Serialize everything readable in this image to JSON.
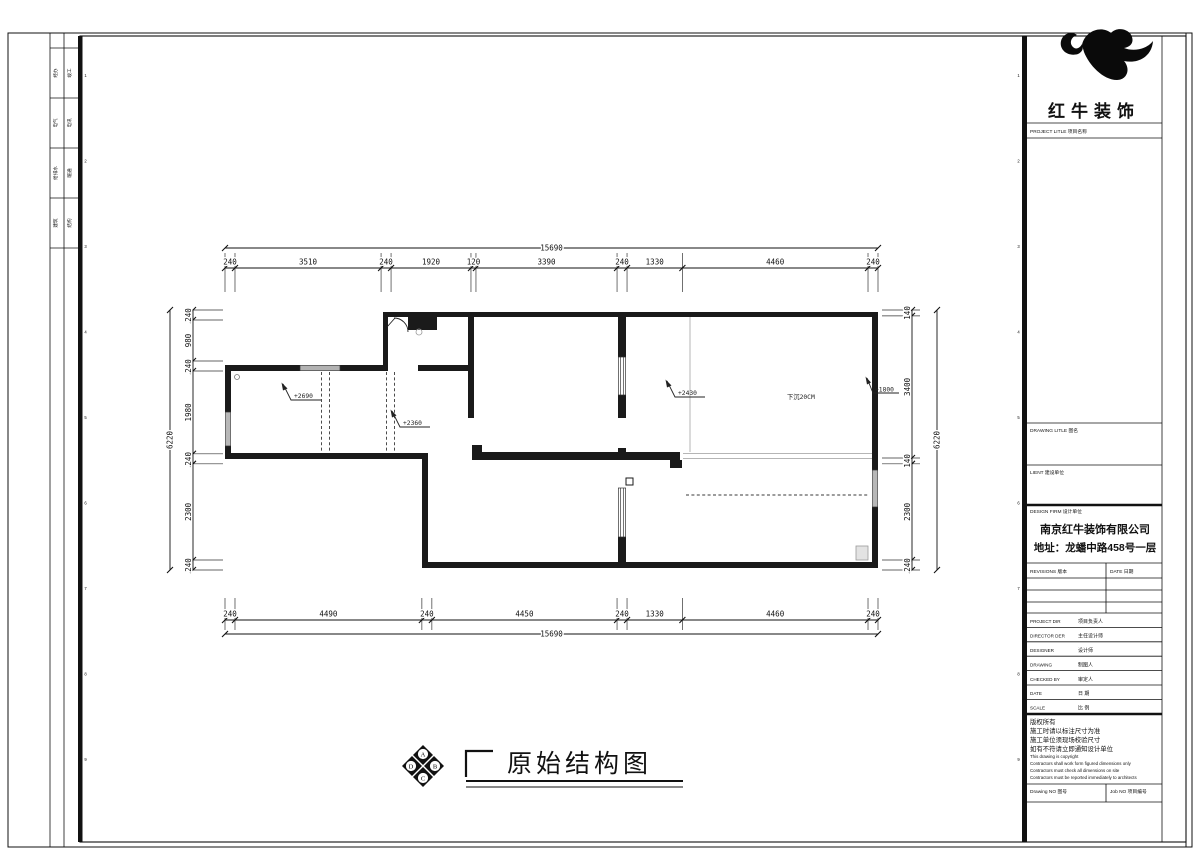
{
  "sheet": {
    "margin_numbers": [
      "1",
      "2",
      "3",
      "4",
      "5",
      "6",
      "7",
      "8",
      "9"
    ],
    "discipline_strip": [
      {
        "col1": "经办",
        "col2": "竣工"
      },
      {
        "col1": "电气",
        "col2": "电讯"
      },
      {
        "col1": "给排水",
        "col2": "暖通"
      },
      {
        "col1": "建筑",
        "col2": "结构"
      }
    ]
  },
  "title_block": {
    "brand": "红牛装饰",
    "project_title_label": "PROJECT LITLE  项目名称",
    "drawing_title_label": "DRAWING LITLE  图名",
    "client_label": "LIENT  建设单位",
    "design_firm_label": "DESIGN FIRM  设计单位",
    "company": "南京红牛装饰有限公司",
    "address": "地址：龙蟠中路458号一层",
    "revisions_label": "REVISIONS  版本",
    "revisions_date_label": "DATE  日期",
    "personnel_rows": [
      {
        "en": "PROJECT DIR",
        "zh": "项目负责人"
      },
      {
        "en": "DIRECTOR DER",
        "zh": "主任设计师"
      },
      {
        "en": "DESIGNER",
        "zh": "设计师"
      },
      {
        "en": "DRAWING",
        "zh": "制图人"
      },
      {
        "en": "CHECKED BY",
        "zh": "审定人"
      },
      {
        "en": "DATE",
        "zh": "日  期"
      },
      {
        "en": "SCALE",
        "zh": "比  例"
      }
    ],
    "copyright_zh": [
      "版权所有",
      "施工时请以标注尺寸为准",
      "施工单位须现场校验尺寸",
      "如有不符请立即通知设计单位"
    ],
    "copyright_en": [
      "This drawing is copyright",
      "Contractors shall work form figured dimensions only",
      "Contractors must check all dimensions on site",
      "Contractors must be reported immediately to architects"
    ],
    "drawing_no_label": "Drawing NO  图号",
    "job_no_label": "Job NO  项目编号"
  },
  "drawing": {
    "title": "原始结构图",
    "compass": {
      "top": "A",
      "right": "B",
      "bottom": "C",
      "left": "D"
    },
    "dimensions": {
      "top": {
        "total": "15690",
        "segments": [
          240,
          3510,
          240,
          1920,
          120,
          3390,
          240,
          1330,
          4460,
          240
        ]
      },
      "bottom": {
        "total": "15690",
        "segments": [
          240,
          4490,
          240,
          4450,
          240,
          1330,
          4460,
          240
        ]
      },
      "left": {
        "total": "6220",
        "segments": [
          240,
          980,
          240,
          1980,
          240,
          2300,
          240
        ]
      },
      "right": {
        "total": "6220",
        "segments": [
          140,
          3400,
          140,
          2300,
          240
        ]
      }
    },
    "annotations": {
      "elev_a": "+2690",
      "elev_b": "+2360",
      "elev_c": "+2430",
      "elev_d": "+1800",
      "beam_note": "下沉20CM"
    }
  }
}
